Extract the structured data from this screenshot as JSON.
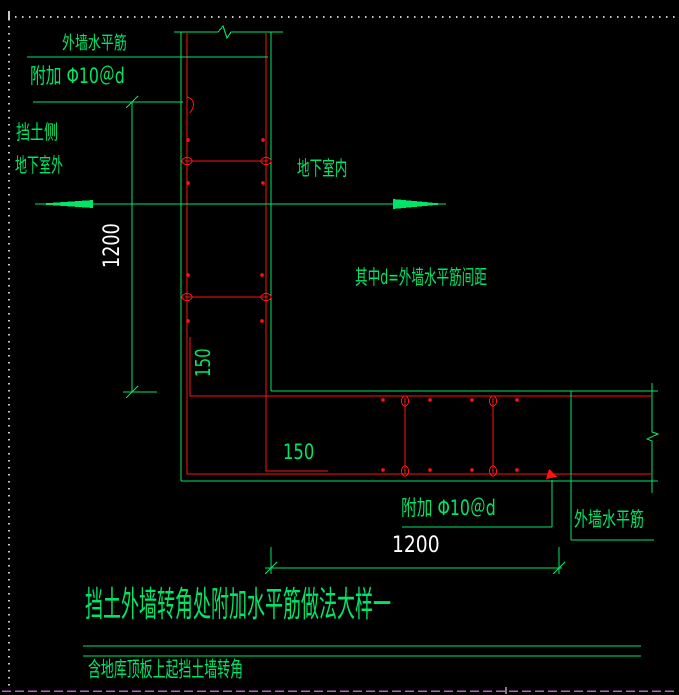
{
  "colors": {
    "background": "#000000",
    "line_green": "#00e566",
    "rebar_red": "#ff1111",
    "dim_white": "#ffffff",
    "border_gray": "#c8c8c8",
    "bottom_magenta": "#bf5ad2"
  },
  "labels": {
    "outer_wall_hbar_top": "外墙水平筋",
    "added_bar_top": "附加 Φ10＠d",
    "retaining_side": "挡土侧",
    "basement_outside": "地下室外",
    "basement_inside": "地下室内",
    "note_d_spacing": "其中d=外墙水平筋间距",
    "leg150_vertical": "150",
    "leg150_horizontal": "150",
    "added_bar_bottom": "附加 Φ10＠d",
    "outer_wall_hbar_bottom": "外墙水平筋",
    "dim_vertical": "1200",
    "dim_horizontal": "1200",
    "title": "挡土外墙转角处附加水平筋做法大样一",
    "subtitle": "含地库顶板上起挡土墙转角"
  }
}
